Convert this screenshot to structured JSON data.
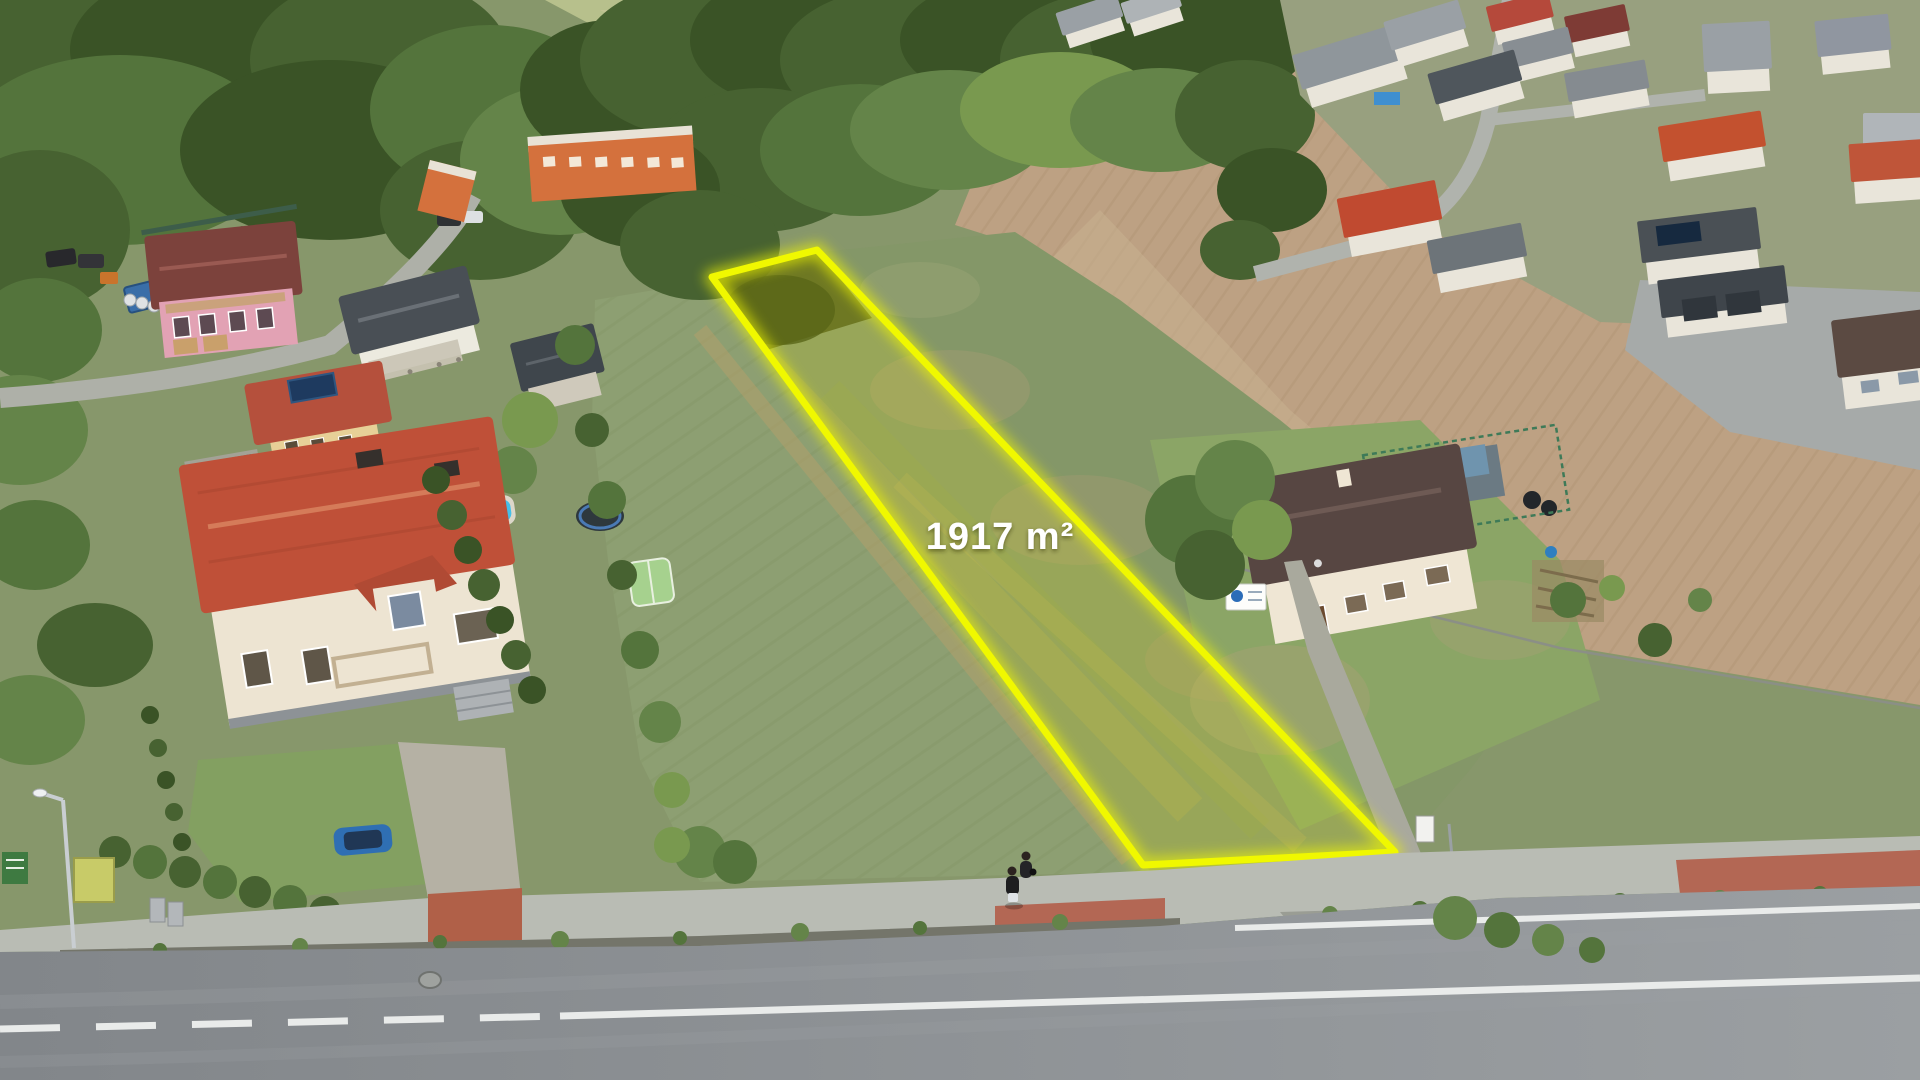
{
  "scene": {
    "type": "aerial-drone-photo",
    "subject": "village with highlighted building plot for sale",
    "plot": {
      "area_label": "1917 m²",
      "outline_color": "#f0f800",
      "fill_tint": "rgba(244,250,0,0.16)",
      "label_color": "#ffffff",
      "polygon_points": "712,277 817,250 1395,852 1143,865"
    }
  }
}
